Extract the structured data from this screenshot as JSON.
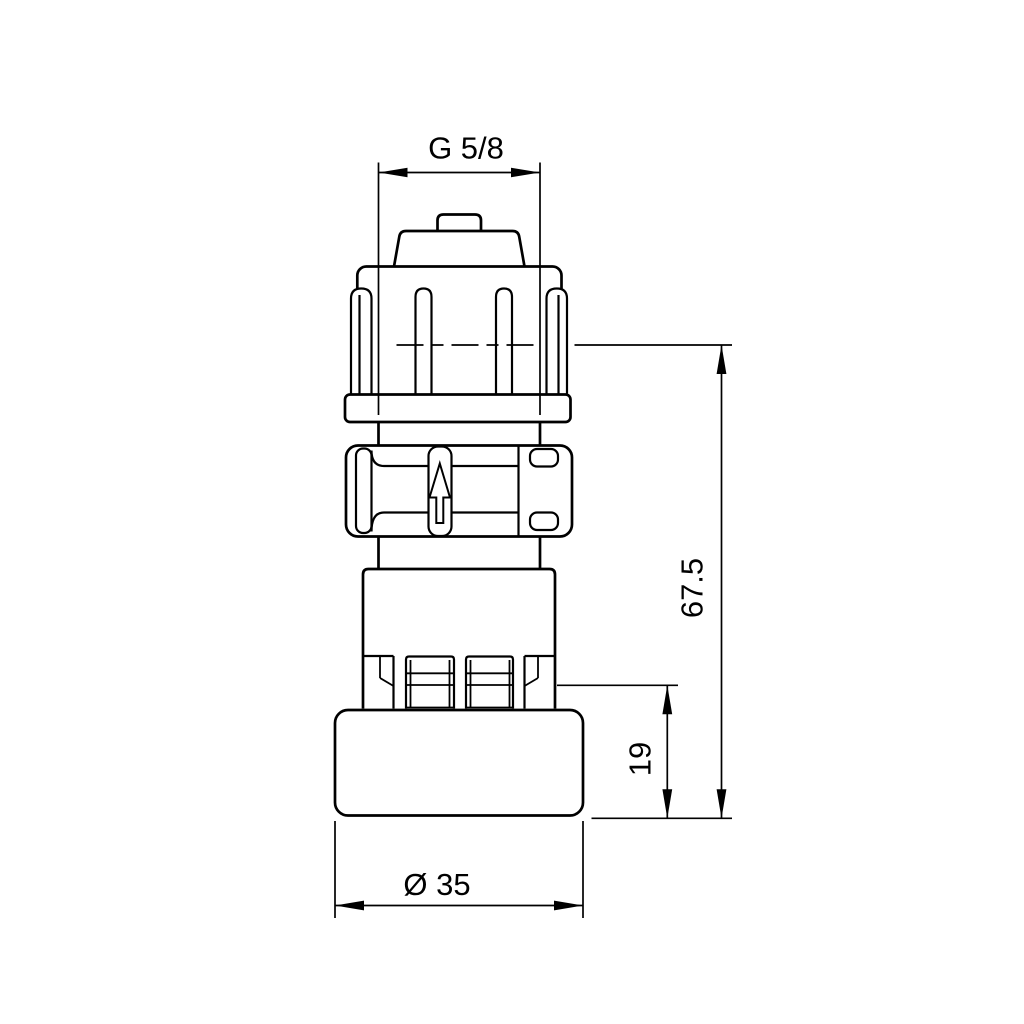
{
  "meta": {
    "background": "#ffffff",
    "line_color": "#000000",
    "drawing_type": "technical dimension drawing, front view"
  },
  "annotations": {
    "thread_size": "G 5/8",
    "overall_height": "67.5",
    "collar_height": "19",
    "base_diameter": "Ø 35"
  },
  "icons": {
    "flow_direction": "up-arrow-outline",
    "dimension_terminators": "filled-slender-arrowheads"
  }
}
